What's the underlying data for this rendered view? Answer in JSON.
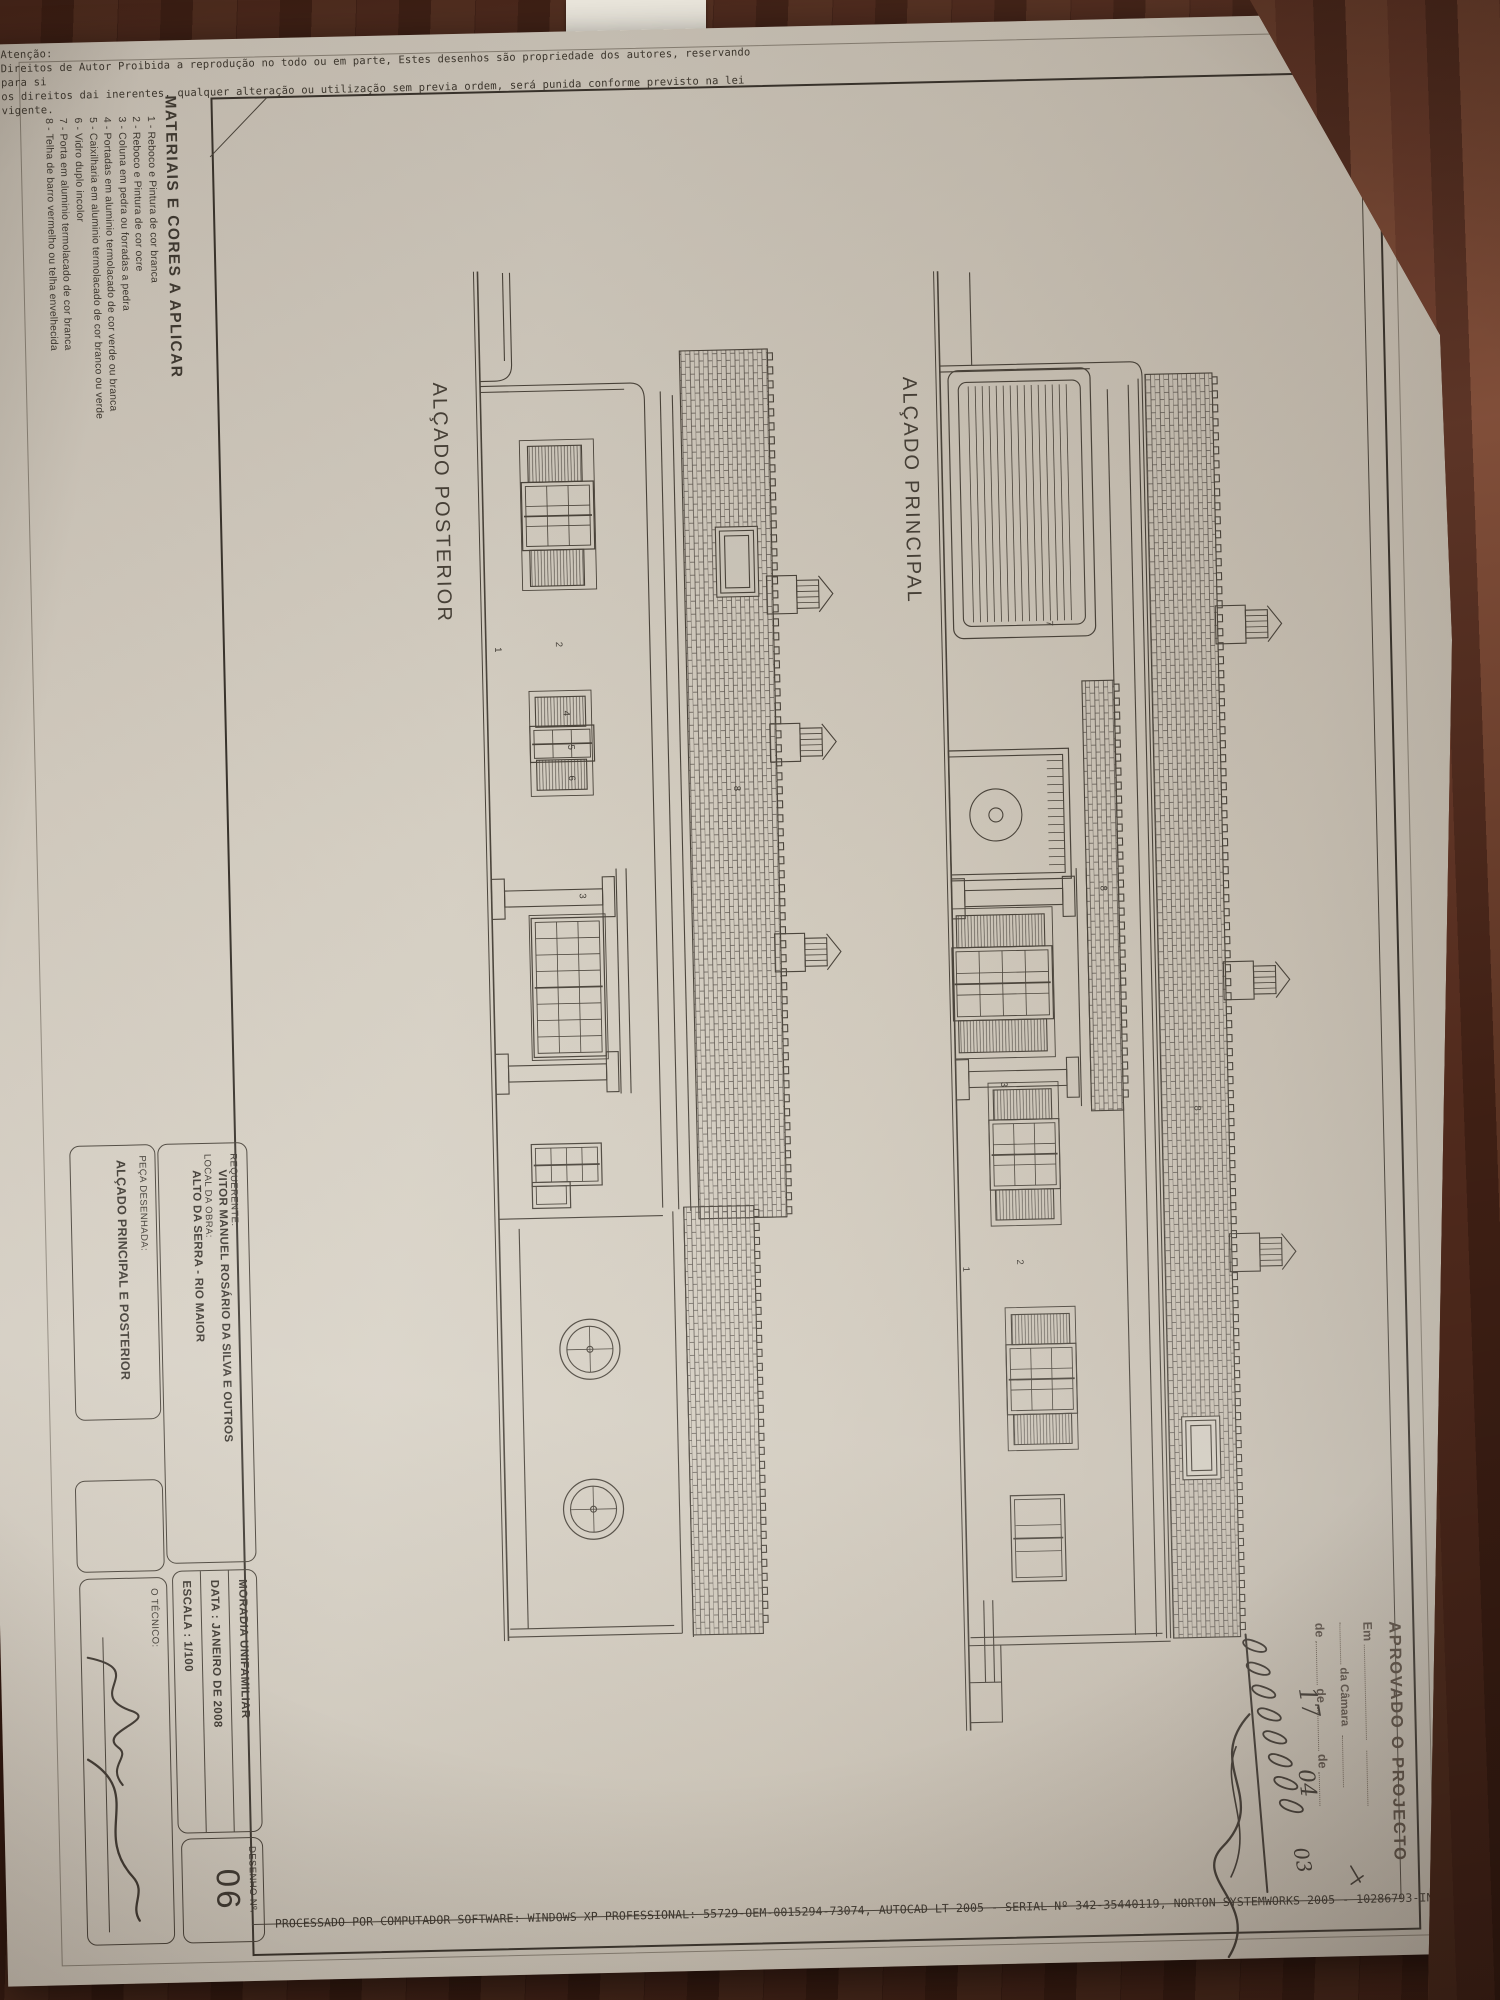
{
  "warning": {
    "title": "Atenção:",
    "lines": [
      "Direitos de Autor Proibida a reprodução no todo ou em parte, Estes desenhos são propriedade dos autores, reservando para si",
      "os direitos dai inerentes, qualquer alteração ou utilização sem previa ordem, será punida conforme previsto na lei vigente."
    ]
  },
  "materials": {
    "title": "MATERIAIS E CORES A APLICAR",
    "items": [
      "1 - Reboco e Pintura de cor branca",
      "2 - Reboco e Pintura de cor ocre",
      "3 - Coluna em pedra ou forradas a pedra",
      "4 - Portadas em aluminio termolacado de cor verde ou branca",
      "5 - Caixilharia em aluminio termolacado de cor branco ou verde",
      "6 - Vidro duplo incolor",
      "7 - Porta em aluminio termolacado de cor branca",
      "8 - Telha de barro vermelho ou telha envelhecida"
    ]
  },
  "stamp": {
    "approved": "APROVADO O PROJECTO",
    "em": "Em",
    "camara": "da Câmara",
    "de": "de",
    "hand_day": "17",
    "hand_month": "04",
    "hand_year": "03"
  },
  "titleblock": {
    "requerente_label": "REQUERENTE:",
    "requerente_value": "VITOR MANUEL ROSÁRIO DA SILVA E OUTROS",
    "local_label": "LOCAL DA OBRA:",
    "local_value": "ALTO DA SERRA - RIO MAIOR",
    "moradia": "MORADIA UNIFAMILIAR",
    "data": "DATA : JANEIRO DE 2008",
    "escala": "ESCALA : 1/100",
    "desenho_label": "DESENHO  Nº.",
    "desenho_num": "06",
    "peca_label": "PEÇA DESENHADA:",
    "peca_value": "ALÇADO PRINCIPAL E POSTERIOR",
    "tecnico_label": "O TÉCNICO:"
  },
  "footer": {
    "processado": "PROCESSADO POR COMPUTADOR SOFTWARE: WINDOWS XP PROFESSIONAL: 55729-OEM-0015294-73074, AUTOCAD LT 2005 - SERIAL Nº 342-35440119, NORTON SYSTEMWORKS 2005 - 10286793-IN"
  },
  "colors": {
    "wood": "#5d2f1f",
    "paper": "#d2ccc0",
    "ink": "#4a443b",
    "frame": "#38332c",
    "stamp_ink": "#5a5047",
    "hand_ink": "#3e3831"
  },
  "drawings": {
    "posterior": {
      "title": "ALÇADO POSTERIOR",
      "length": 1370,
      "chimney_base": 66,
      "outline": [
        "M2,318 H94 Q110,318 110,335 V350",
        "M2,325 H90",
        "M115,350 V200 Q115,186 132,186 H940",
        "M121,350 V206",
        "M128,158 H944",
        "M124,170 H942",
        "M948,186 V350",
        "M952,62 V95",
        "M940,165 H1370",
        "M944,176 H1366",
        "M1366,176 V350",
        "M1358,184 V348",
        "M958,330 H1358"
      ],
      "roofs": [
        {
          "x": 84,
          "y": 62,
          "w": 868,
          "h": 88
        },
        {
          "x": 940,
          "y": 95,
          "w": 428,
          "h": 70
        }
      ],
      "skylights": [
        {
          "x": 265,
          "y": 80,
          "w": 62,
          "h": 34
        }
      ],
      "surrounds": [
        {
          "x": 170,
          "y": 238,
          "w": 150,
          "h": 74
        },
        {
          "x": 421,
          "y": 246,
          "w": 105,
          "h": 62
        },
        {
          "x": 645,
          "y": 237,
          "w": 145,
          "h": 76
        }
      ],
      "shutters": [
        {
          "x": 176,
          "y": 250,
          "w": 36,
          "h": 54
        },
        {
          "x": 280,
          "y": 250,
          "w": 36,
          "h": 54
        },
        {
          "x": 427,
          "y": 252,
          "w": 30,
          "h": 50
        },
        {
          "x": 490,
          "y": 252,
          "w": 30,
          "h": 50
        }
      ],
      "windows": [
        {
          "x": 216,
          "y": 243,
          "w": 60,
          "h": 64,
          "c": 3,
          "r": 3
        },
        {
          "x": 460,
          "y": 248,
          "w": 28,
          "h": 56,
          "c": 2,
          "r": 3
        },
        {
          "x": 652,
          "y": 243,
          "w": 131,
          "h": 64,
          "c": 8,
          "r": 3
        },
        {
          "x": 878,
          "y": 250,
          "w": 34,
          "h": 62,
          "c": 2,
          "r": 4
        },
        {
          "x": 916,
          "y": 282,
          "w": 18,
          "h": 30,
          "c": 1,
          "r": 1
        }
      ],
      "columns": [
        617,
        792
      ],
      "beams": [
        {
          "x1": 600,
          "x2": 825,
          "y": 215
        }
      ],
      "chimneys": [
        330,
        478,
        688
      ],
      "circles": [
        {
          "cx": 1080,
          "cy": 262,
          "r": 30
        },
        {
          "cx": 1240,
          "cy": 262,
          "r": 30
        }
      ],
      "labels": [
        {
          "t": "1",
          "x": 376,
          "y": 341
        },
        {
          "t": "2",
          "x": 372,
          "y": 280
        },
        {
          "t": "3",
          "x": 624,
          "y": 262
        },
        {
          "t": "4",
          "x": 441,
          "y": 274
        },
        {
          "t": "5",
          "x": 475,
          "y": 270
        },
        {
          "t": "6",
          "x": 506,
          "y": 270
        },
        {
          "t": "8",
          "x": 520,
          "y": 105
        }
      ]
    },
    "principal": {
      "title": "ALÇADO PRINCIPAL",
      "length": 1460,
      "chimney_base": 78,
      "outline": [
        "M2,318 H95",
        "M95,350 V160 Q95,148 110,148 H1372",
        "M101,350 V200",
        "M112,152 H1372",
        "M118,162 H1370",
        "M122,183 H1368",
        "M1375,148 V350",
        "M1367,156 V348",
        "M1330,325 H1412",
        "M1330,334 H1412",
        "M1412,318 V350",
        "M1375,318 H1452 V350"
      ],
      "roofs": [
        {
          "x": 108,
          "y": 78,
          "w": 1264,
          "h": 67
        },
        {
          "x": 413,
          "y": 183,
          "w": 430,
          "h": 32
        }
      ],
      "skylights": [
        {
          "x": 1155,
          "y": 98,
          "w": 55,
          "h": 30
        }
      ],
      "garage": {
        "x": 100,
        "y": 200,
        "w": 268,
        "h": 142
      },
      "door": {
        "x": 480,
        "y": 230,
        "w": 130,
        "h": 120
      },
      "surrounds": [
        {
          "x": 638,
          "y": 250,
          "w": 150,
          "h": 100
        },
        {
          "x": 813,
          "y": 248,
          "w": 143,
          "h": 70
        },
        {
          "x": 1038,
          "y": 236,
          "w": 143,
          "h": 70
        }
      ],
      "shutters": [
        {
          "x": 645,
          "y": 258,
          "w": 32,
          "h": 88
        },
        {
          "x": 750,
          "y": 258,
          "w": 32,
          "h": 88
        },
        {
          "x": 820,
          "y": 255,
          "w": 30,
          "h": 58
        },
        {
          "x": 920,
          "y": 255,
          "w": 30,
          "h": 58
        },
        {
          "x": 1045,
          "y": 242,
          "w": 30,
          "h": 58
        },
        {
          "x": 1145,
          "y": 242,
          "w": 30,
          "h": 58
        }
      ],
      "windows": [
        {
          "x": 681,
          "y": 255,
          "w": 65,
          "h": 92,
          "c": 3,
          "r": 4
        },
        {
          "x": 854,
          "y": 252,
          "w": 62,
          "h": 62,
          "c": 3,
          "r": 3
        },
        {
          "x": 1079,
          "y": 240,
          "w": 62,
          "h": 62,
          "c": 3,
          "r": 3
        },
        {
          "x": 1230,
          "y": 255,
          "w": 78,
          "h": 46,
          "c": 3,
          "r": 1
        }
      ],
      "columns": [
        617,
        798
      ],
      "beams": [
        {
          "x1": 600,
          "x2": 838,
          "y": 215
        }
      ],
      "chimneys": [
        360,
        716,
        988
      ],
      "circles": [],
      "labels": [
        {
          "t": "1",
          "x": 996,
          "y": 347
        },
        {
          "t": "2",
          "x": 990,
          "y": 293
        },
        {
          "t": "3",
          "x": 812,
          "y": 305
        },
        {
          "t": "7",
          "x": 352,
          "y": 249
        },
        {
          "t": "8",
          "x": 618,
          "y": 201
        },
        {
          "t": "8",
          "x": 840,
          "y": 112
        }
      ]
    }
  }
}
